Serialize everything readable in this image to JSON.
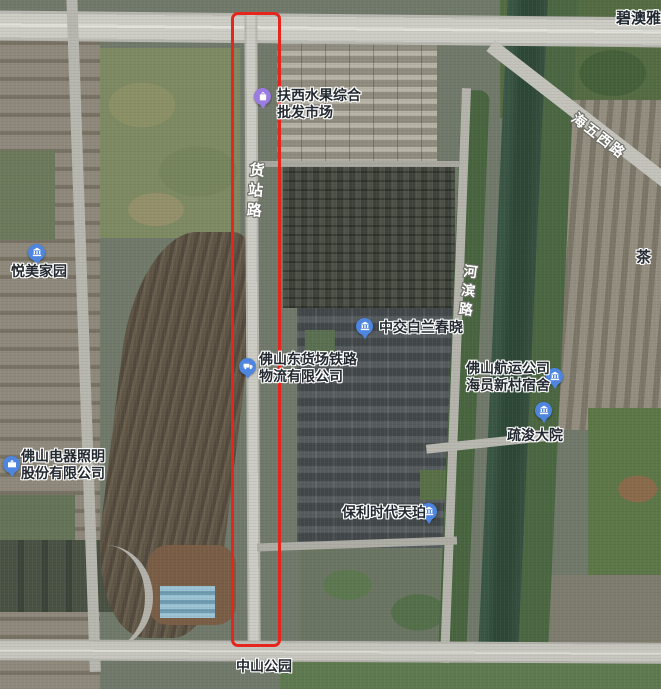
{
  "map": {
    "kind": "satellite imagery with red rectangle annotation highlighting a road",
    "annotation": {
      "shape": "rectangle",
      "color": "#e6261c",
      "highlights": "货站路"
    },
    "colors": {
      "marker_blue": "#4e86df",
      "marker_purple": "#9a7be0",
      "poi_text": "#232931",
      "road_text": "#ffffff"
    }
  },
  "roads": {
    "huozhanlu": {
      "text": "货站路",
      "orientation": "vertical"
    },
    "hebinlu": {
      "text": "河滨路",
      "orientation": "vertical"
    },
    "haiwuxilu": {
      "text": "海五西路",
      "orientation": "diagonal"
    }
  },
  "pois": {
    "fruit_market": {
      "line1": "扶西水果综合",
      "line2": "批发市场",
      "icon": "shopping-bag-icon",
      "marker_color": "#9a7be0"
    },
    "yuemei": {
      "text": "悦美家园",
      "icon": "building-icon",
      "marker_color": "#4e86df"
    },
    "biaoyayuan": {
      "text": "碧澳雅苑",
      "icon": "none"
    },
    "zhongjiao": {
      "text": "中交白兰春晓",
      "icon": "building-icon",
      "marker_color": "#4e86df"
    },
    "logistics": {
      "line1": "佛山东货场铁路",
      "line2": "物流有限公司",
      "icon": "truck-icon",
      "marker_color": "#4e86df"
    },
    "hangyun": {
      "line1": "佛山航运公司",
      "line2": "海员新村宿舍",
      "icon": "building-icon",
      "marker_color": "#4e86df"
    },
    "cha": {
      "text": "茶",
      "icon": "none"
    },
    "fsl": {
      "line1": "佛山电器照明",
      "line2": "股份有限公司",
      "icon": "briefcase-icon",
      "marker_color": "#4e86df"
    },
    "shujun": {
      "text": "疏浚大院",
      "icon": "building-icon",
      "marker_color": "#4e86df"
    },
    "poly": {
      "text": "保利时代天珀",
      "icon": "building-icon",
      "marker_color": "#4e86df"
    },
    "zhongshan_park": {
      "text": "中山公园",
      "icon": "none"
    }
  }
}
